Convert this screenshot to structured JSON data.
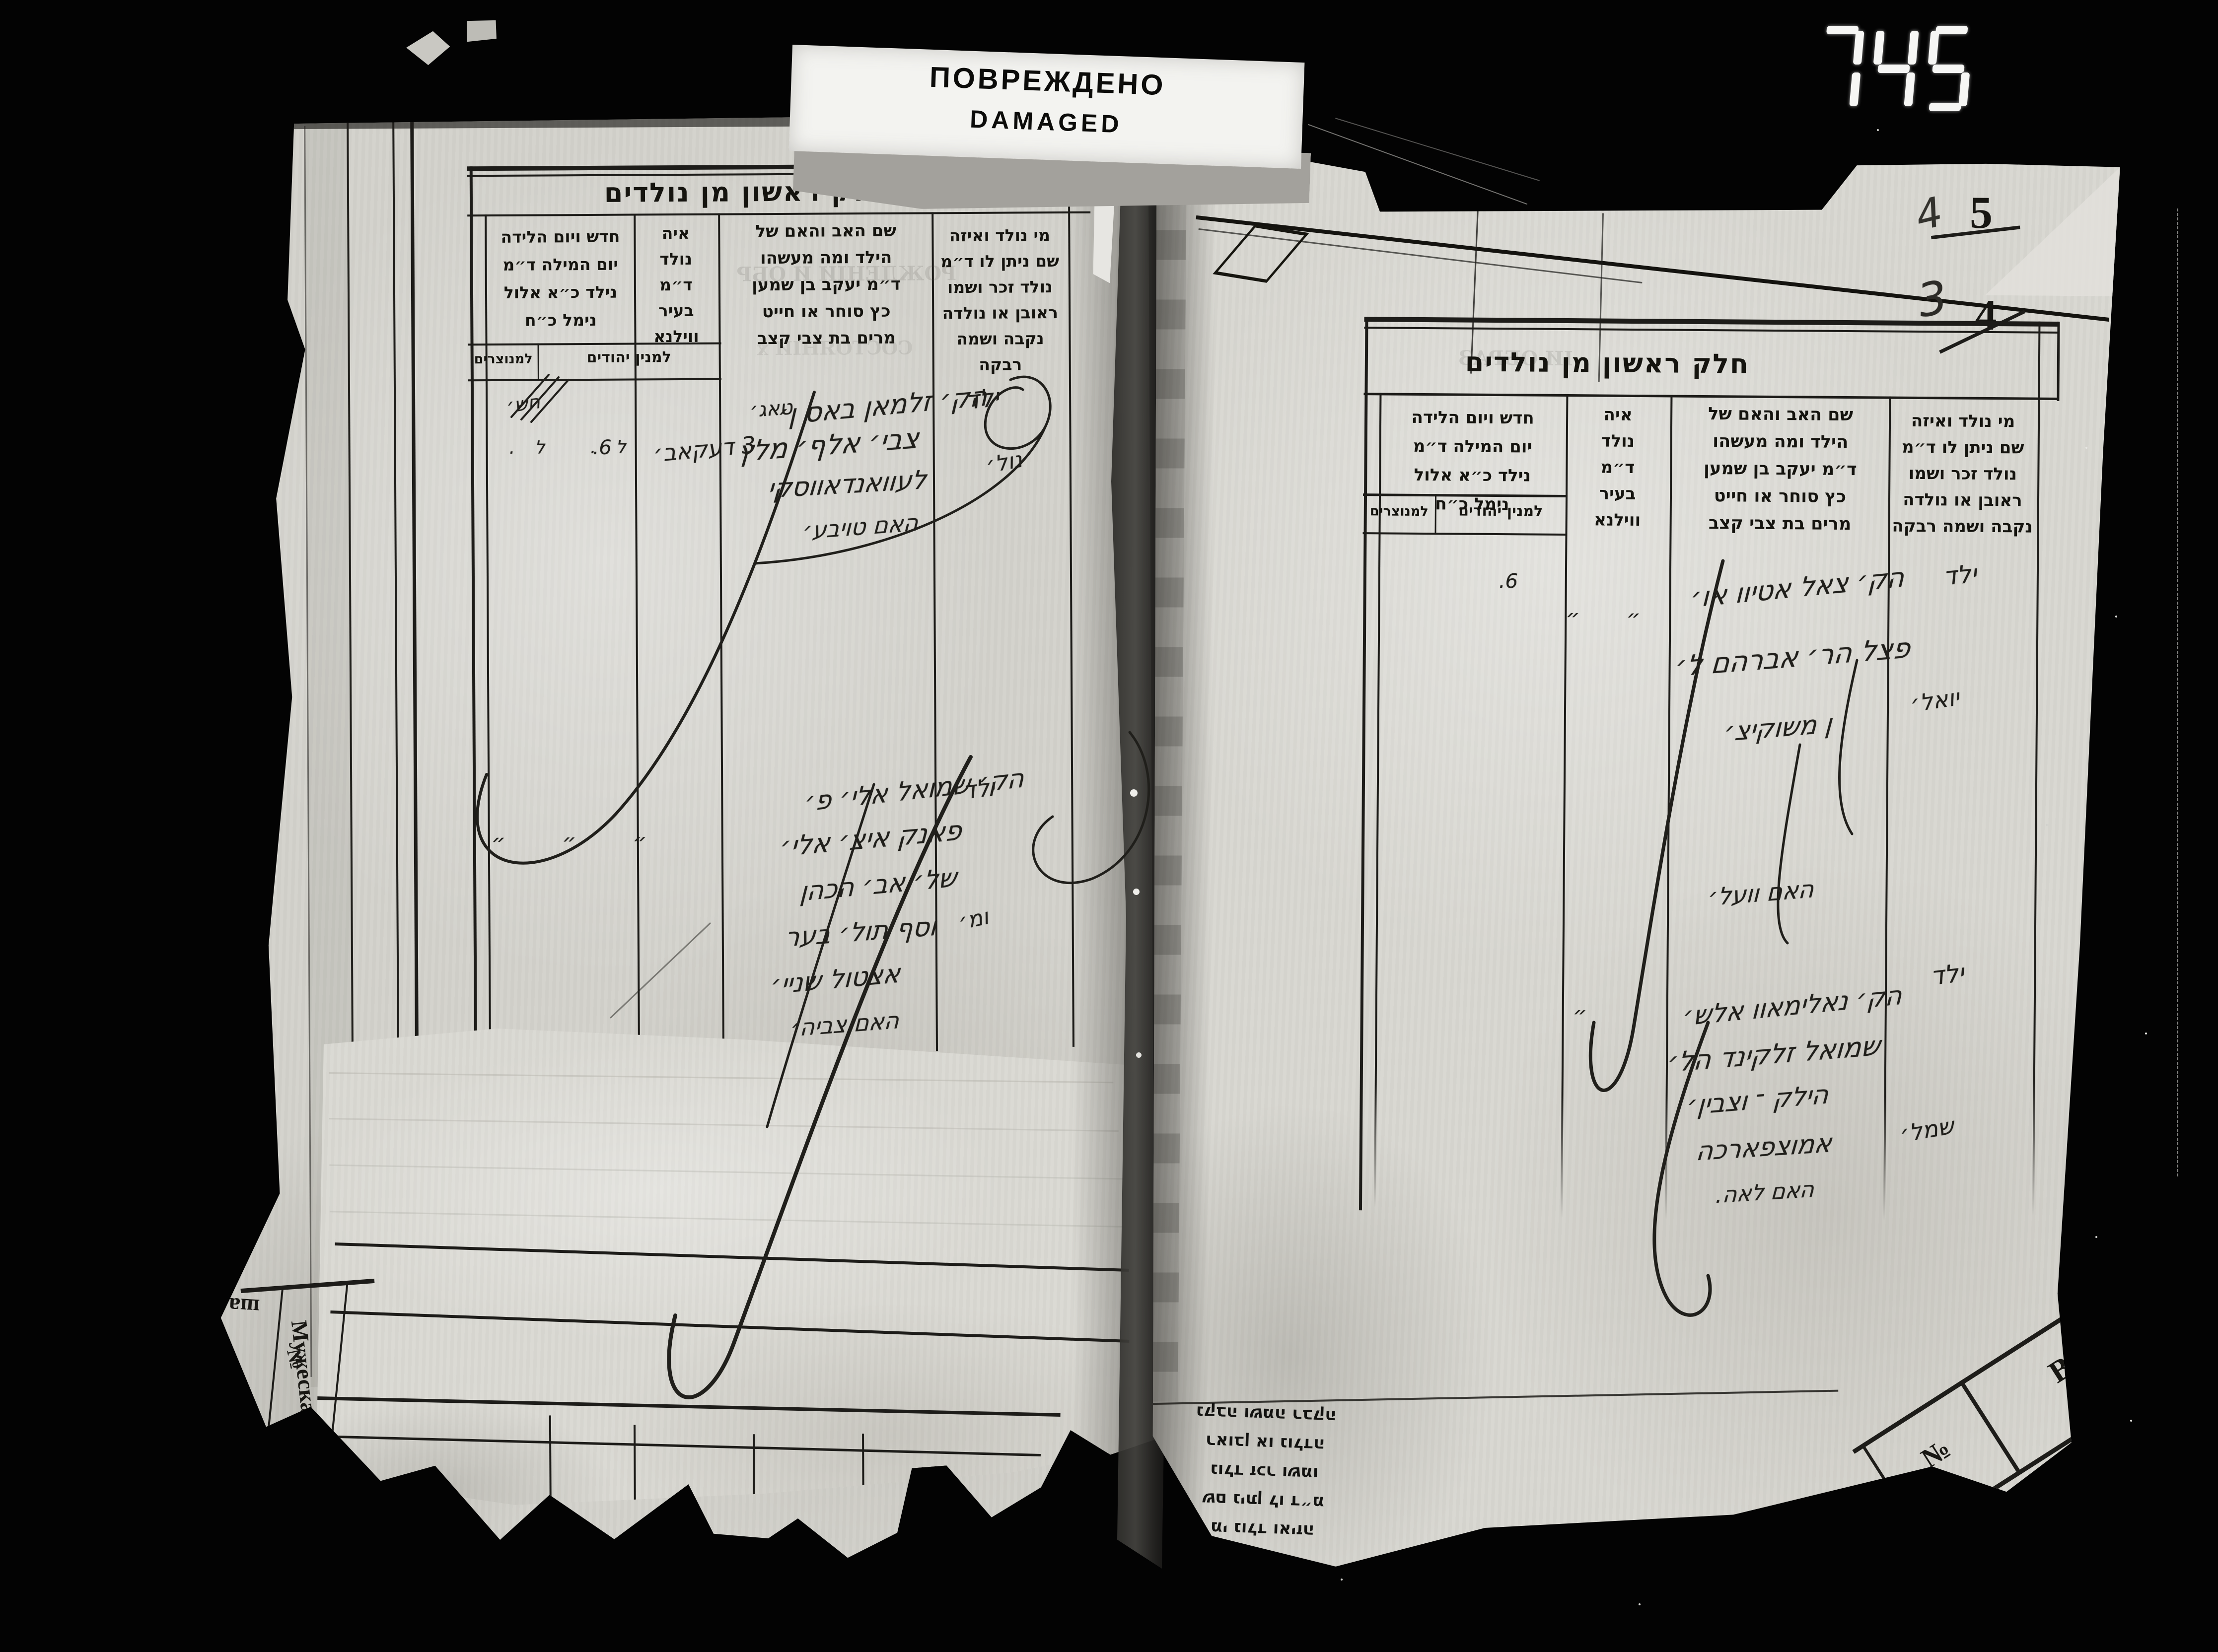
{
  "photo": {
    "damaged_label": {
      "line_ru": "ПОВРЕЖДЕНО",
      "line_en": "DAMAGED"
    },
    "folio_counter": "745",
    "page_corner_numbers": {
      "top_handwritten": "4",
      "top_printed_struck": "5",
      "bottom_handwritten": "3",
      "bottom_printed_struck": "4"
    }
  },
  "form": {
    "title": "חלק ראשון מן נולדים",
    "col_date_header": [
      "חדש ויום הלידה",
      "יום המילה ד״מ",
      "נילד כ״א אלול",
      "נימל כ״ח"
    ],
    "col_date_sub_jewish": "למנין יהודים",
    "col_date_sub_christian": "למנוצרים",
    "col_where_header": [
      "איה",
      "נולד",
      "ד״מ",
      "בעיר",
      "ווילנא"
    ],
    "col_parents_header": [
      "שם האב והאם של",
      "הילד ומה מעשהו",
      "ד״מ יעקב בן שמען",
      "כץ סוחר או חייט",
      "מרים בת צבי קצב"
    ],
    "col_who_header": [
      "מי נולד ואיזה",
      "שם ניתן לו ד״מ",
      "נולד זכר ושמו",
      "ראובן או נולדה",
      "נקבה ושמה רבקה"
    ]
  },
  "left_page": {
    "entry1": {
      "who": "ילד",
      "who2": "נול׳",
      "where": "טאג׳",
      "where2": "3 דעקאב׳",
      "date_top": "חש׳",
      "date_marks": "ל.  ל.",
      "date_right": "6.",
      "parents": [
        "הק׳ זלמאן באס ן׳",
        "צבי׳ אלף׳ מלץ",
        "לעוואנדאווסקי",
        "האם טויבע׳"
      ]
    },
    "entry2": {
      "dittos": "״   ״   ״",
      "who": "ילד",
      "who2": "ומ׳",
      "parents": [
        "הק׳ שמואל אלי׳ פ׳",
        "פאנק איצ׳ אלי׳",
        "של׳ אב׳ הכהן",
        "וסף תול׳ בער",
        "אצטול שניי׳",
        "האם צביה׳"
      ]
    },
    "ghost_lines": [
      "РОЖДЕНІИ И ОБР",
      "СОСТОЯНІИ х"
    ]
  },
  "right_page": {
    "entry1": {
      "dittos": "״  ״",
      "date_right": "6.",
      "who": "ילד",
      "who2": "יואל׳",
      "parents": [
        "הק׳ צאל אטיוו או׳",
        "פצל הר׳ אברהם ל׳",
        "ן משוקיצ׳",
        "האם וועל׳"
      ]
    },
    "entry2": {
      "ditto": "״",
      "who": "ילד",
      "who2": "שמל׳",
      "parents": [
        "הק׳ נאלימאוו אלש׳",
        "שמואל זלקינד הל׳",
        "הילק ־ וצבין׳",
        "אמוצפארכה",
        "האם לאה."
      ]
    },
    "flipped_block": [
      "מי נולד ואיזה",
      "שם ניתן לו ד״מ",
      "נולד זכר ושמו",
      "ראובן או נולדה",
      "נקבה ושמה רבקה"
    ],
    "ghost_line": "ІИ ОБРАЗ"
  },
  "margin_stamps": {
    "gender_label": "Мужескаго.",
    "number_sign": "№",
    "corner_letter": "В",
    "flipped_scraps": [
      "шал",
      "го"
    ]
  }
}
